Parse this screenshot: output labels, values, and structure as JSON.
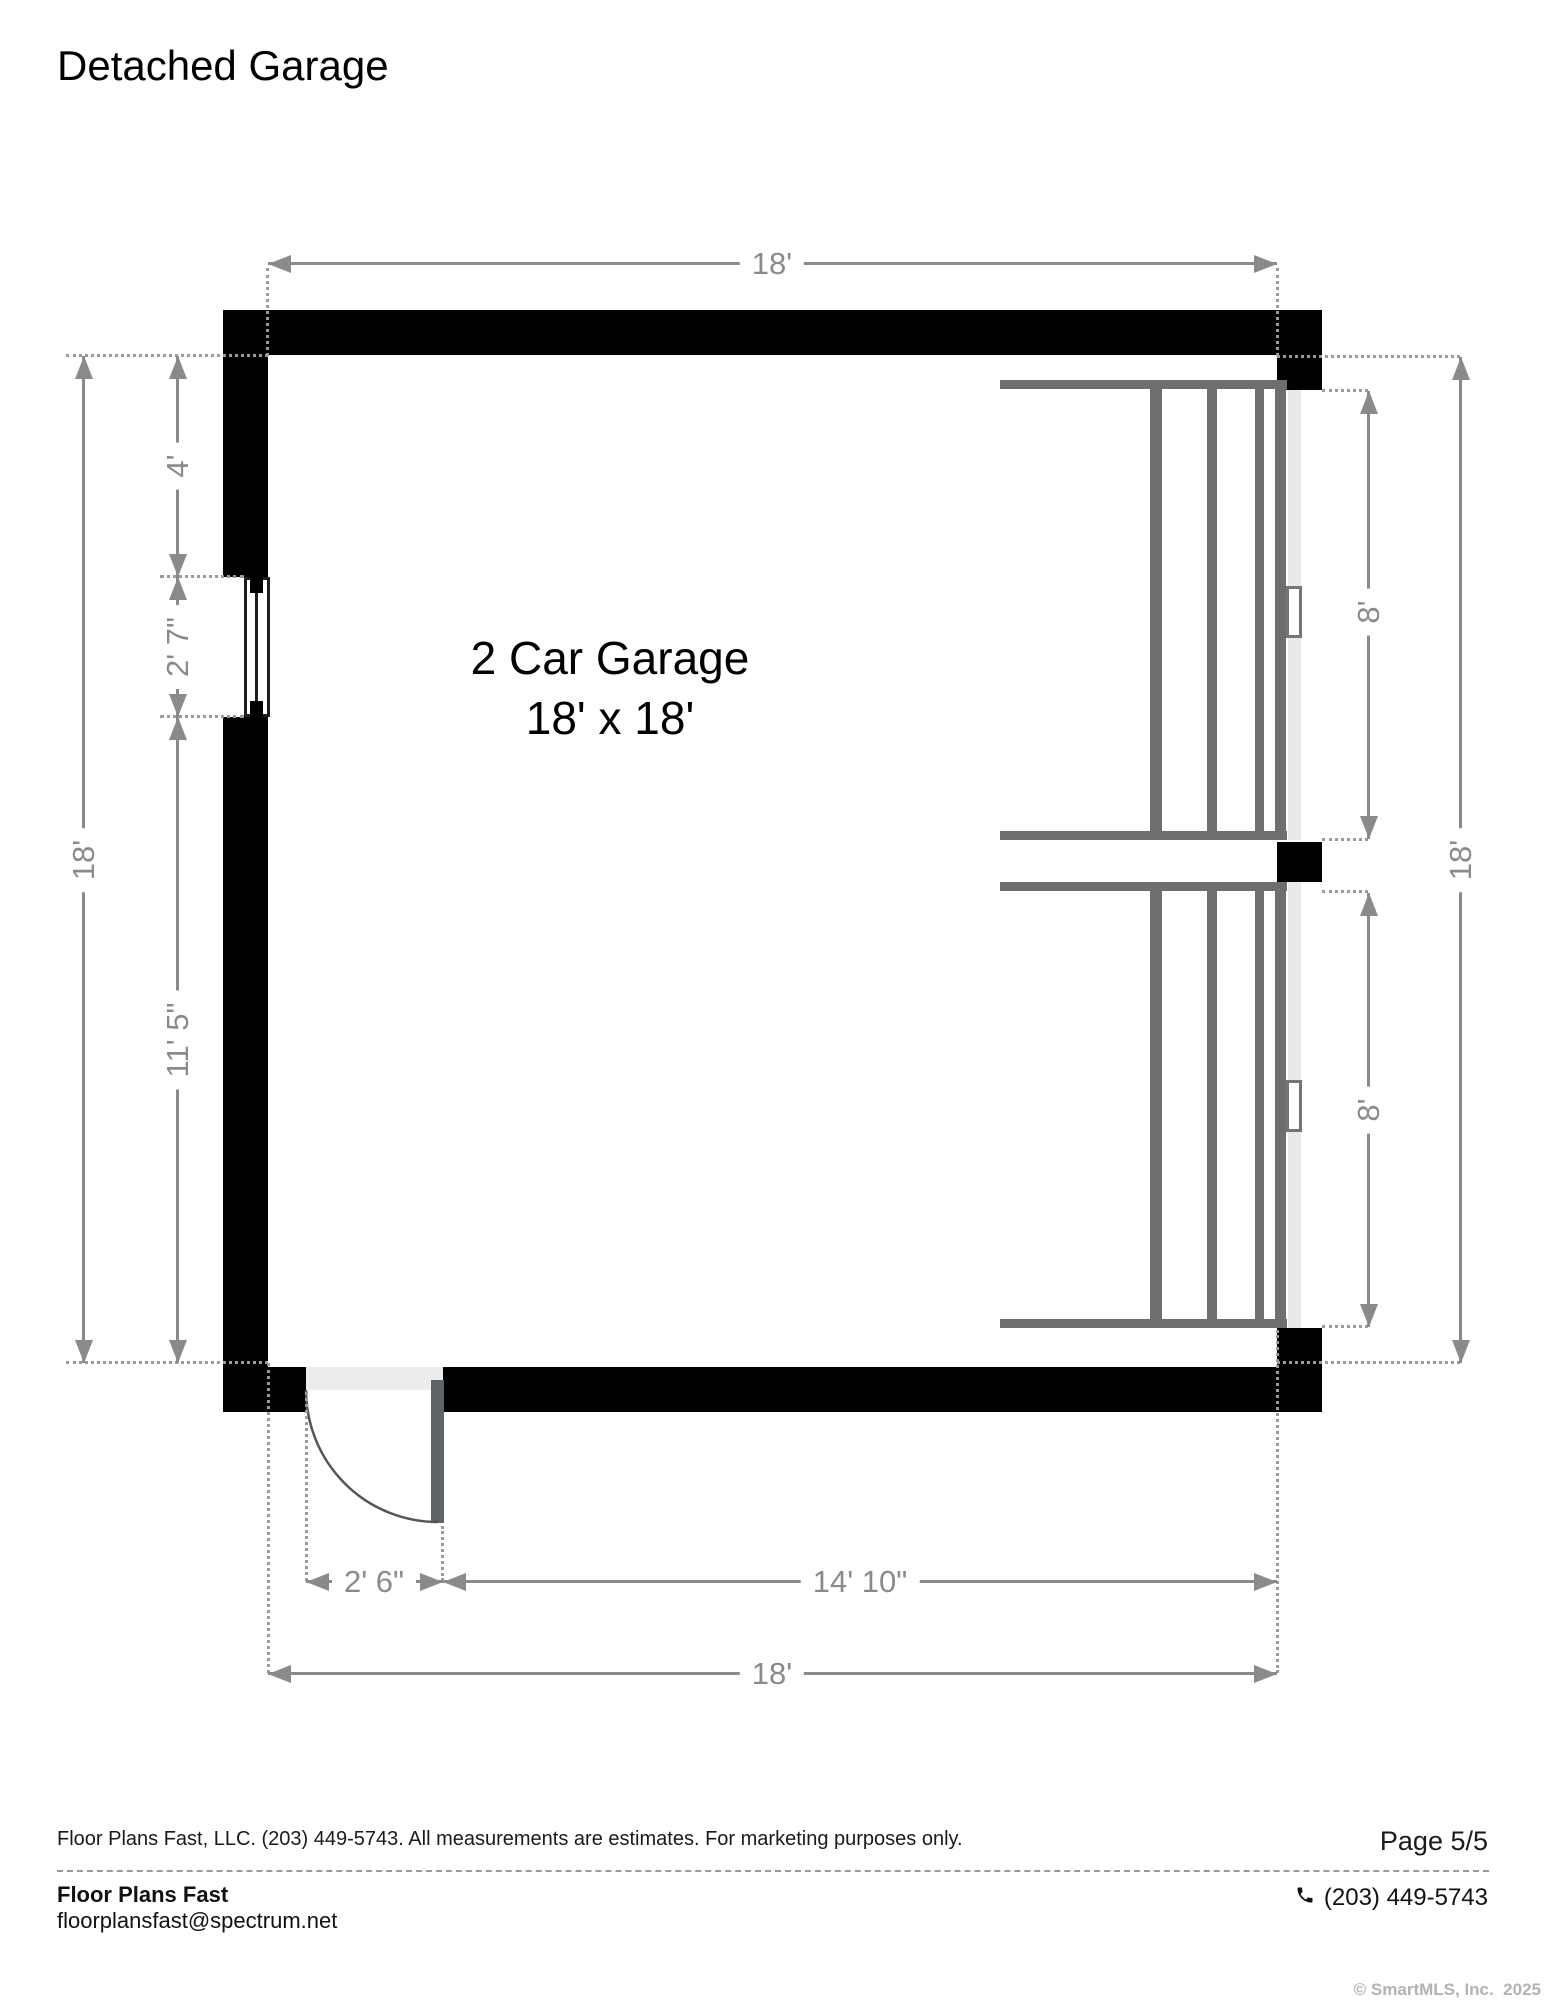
{
  "title": "Detached Garage",
  "room": {
    "name": "2 Car Garage",
    "size": "18' x 18'"
  },
  "dimensions": {
    "top_width": "18'",
    "left_overall": "18'",
    "left_top_segment": "4'",
    "left_window": "2' 7\"",
    "left_bottom_segment": "11' 5\"",
    "right_overall": "18'",
    "right_door1": "8'",
    "right_door2": "8'",
    "bottom_entry_door": "2' 6\"",
    "bottom_right_segment": "14' 10\"",
    "bottom_overall": "18'"
  },
  "footer": {
    "disclaimer": "Floor Plans Fast, LLC. (203) 449-5743. All measurements are estimates. For marketing purposes only.",
    "page": "Page 5/5",
    "company": "Floor Plans Fast",
    "email": "floorplansfast@spectrum.net",
    "phone": "(203) 449-5743",
    "copyright": "© SmartMLS, Inc.  2025"
  },
  "colors": {
    "wall": "#000000",
    "dimension": "#8a8a8a",
    "garage_door": "#6e6e6e",
    "door_slab": "#e9e9e9",
    "threshold": "#ececec"
  }
}
